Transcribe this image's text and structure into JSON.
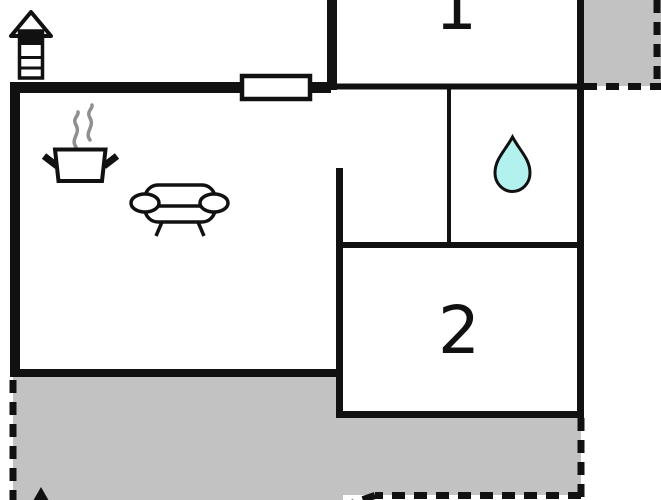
{
  "plan": {
    "title": "floor-plan",
    "rooms": [
      {
        "id": "room-1",
        "label": "1"
      },
      {
        "id": "room-2",
        "label": "2"
      }
    ],
    "icons": {
      "chimney": "chimney-icon",
      "stove": "cooking-pot-icon",
      "sofa": "sofa-icon",
      "bathroom": "water-drop-icon",
      "compass": "north-arrow-icon",
      "window": "window-symbol"
    },
    "colors": {
      "wall": "#111111",
      "terrace": "#c2c2c2",
      "water_drop": "#b3f1ef",
      "steam": "#8f8f8f",
      "window": "#ffffff"
    }
  }
}
